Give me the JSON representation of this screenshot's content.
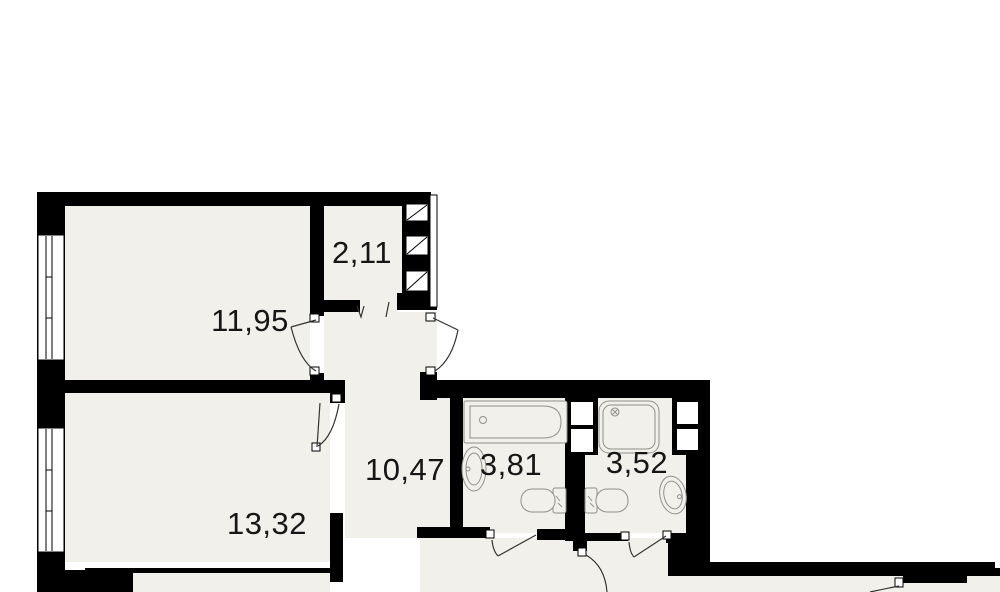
{
  "rooms": [
    {
      "id": "room-top-left",
      "area": "11,95"
    },
    {
      "id": "room-top-small",
      "area": "2,11"
    },
    {
      "id": "room-bottom-left",
      "area": "13,32"
    },
    {
      "id": "hallway",
      "area": "10,47"
    },
    {
      "id": "bathroom-left",
      "area": "3,81"
    },
    {
      "id": "bathroom-right",
      "area": "3,52"
    }
  ],
  "colors": {
    "wall": "#000000",
    "floor": "#f1f0ea",
    "fixture": "#90908c",
    "door_line": "#333333",
    "background": "#ffffff"
  }
}
